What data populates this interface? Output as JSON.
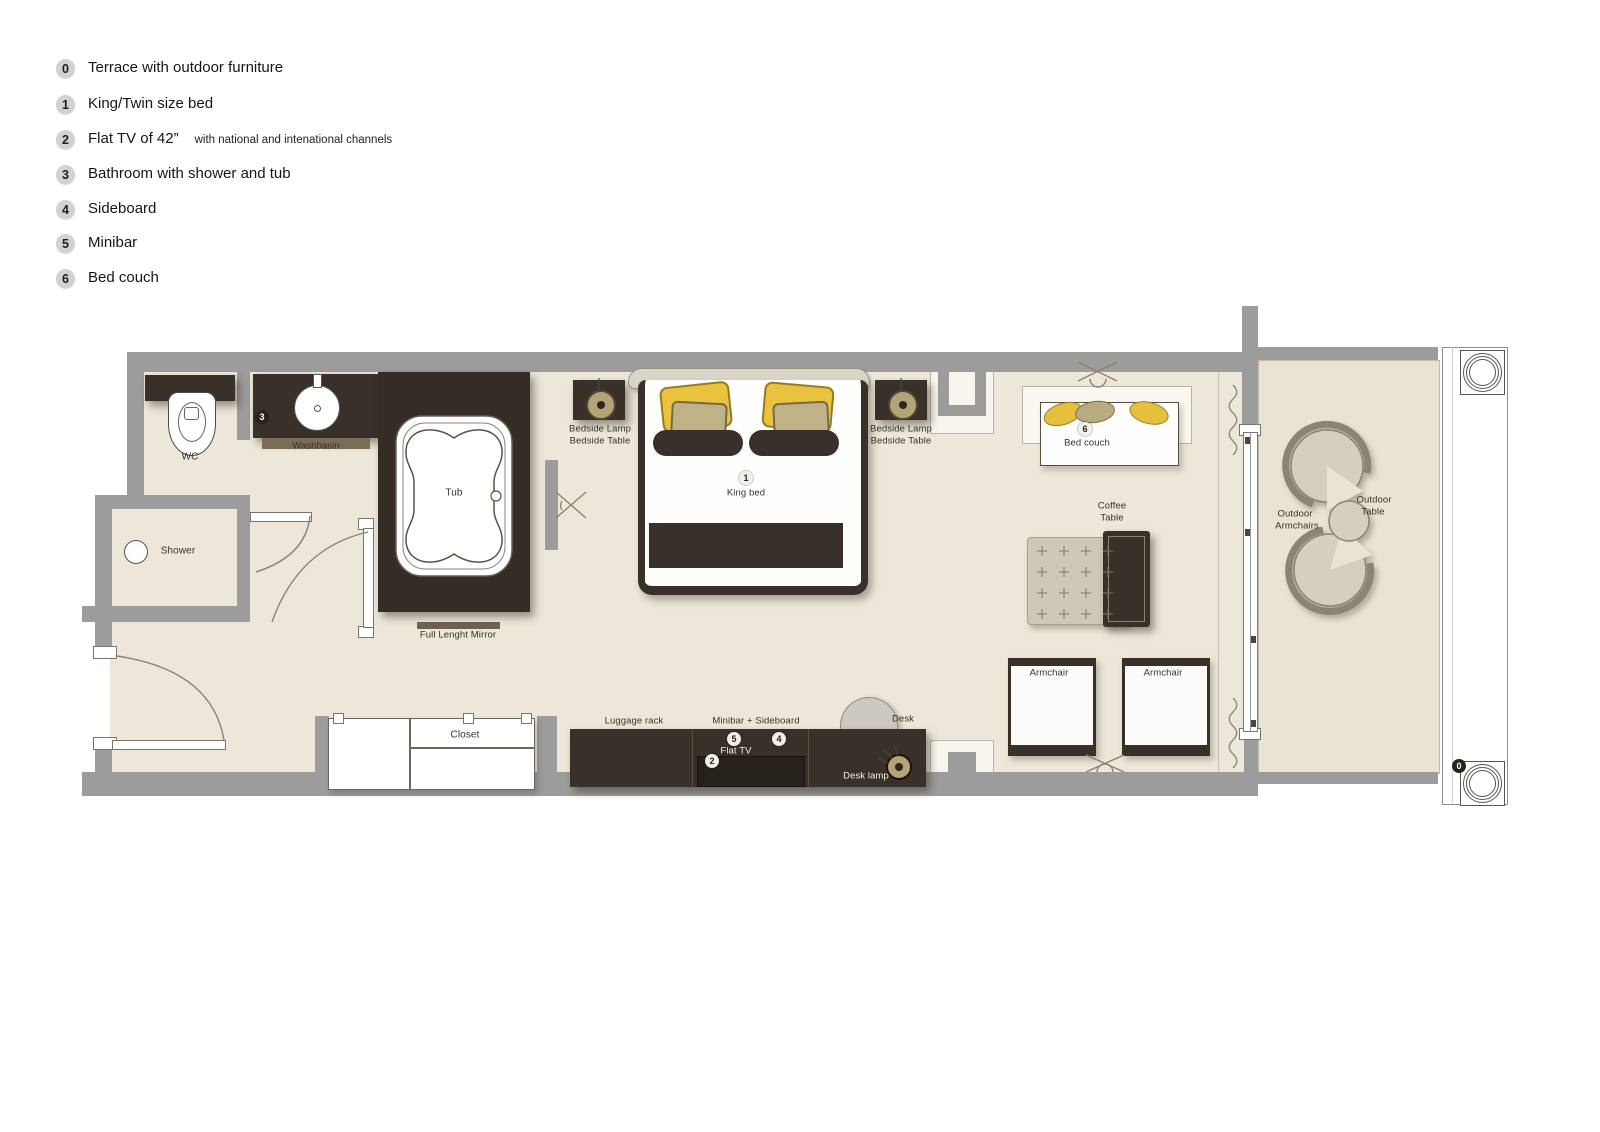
{
  "legend": {
    "items": [
      {
        "num": "0",
        "text": "Terrace with outdoor furniture",
        "suffix": ""
      },
      {
        "num": "1",
        "text": "King/Twin size bed",
        "suffix": ""
      },
      {
        "num": "2",
        "text": "Flat TV of 42”",
        "suffix": "with national and intenational channels"
      },
      {
        "num": "3",
        "text": "Bathroom with shower and tub",
        "suffix": ""
      },
      {
        "num": "4",
        "text": "Sideboard",
        "suffix": ""
      },
      {
        "num": "5",
        "text": "Minibar",
        "suffix": ""
      },
      {
        "num": "6",
        "text": "Bed couch",
        "suffix": ""
      }
    ]
  },
  "plan": {
    "labels": {
      "wc": "WC",
      "washbasin": "Washbasin",
      "tub": "Tub",
      "shower": "Shower",
      "full_length_mirror": "Full Lenght Mirror",
      "bedside_lamp": "Bedside Lamp",
      "bedside_table": "Bedside Table",
      "king_bed": "King bed",
      "bed_couch": "Bed couch",
      "coffee": "Coffee",
      "table": "Table",
      "armchair": "Armchair",
      "closet": "Closet",
      "luggage_rack": "Luggage rack",
      "minibar_sideboard": "Minibar + Sideboard",
      "flat_tv": "Flat TV",
      "desk": "Desk",
      "desk_lamp": "Desk lamp",
      "outdoor": "Outdoor",
      "armchairs": "Armchairs"
    },
    "badges": {
      "terrace": "0",
      "bed": "1",
      "tv": "2",
      "bath": "3",
      "sideboard": "4",
      "minibar": "5",
      "couch": "6"
    },
    "colors": {
      "floor": "#ece7d8",
      "terrace_floor": "#eae3d1",
      "wall": "#9c9c9c",
      "dark_wood": "#39302a",
      "pillow_yellow": "#e9c33d",
      "pillow_tan": "#bfb287"
    }
  }
}
